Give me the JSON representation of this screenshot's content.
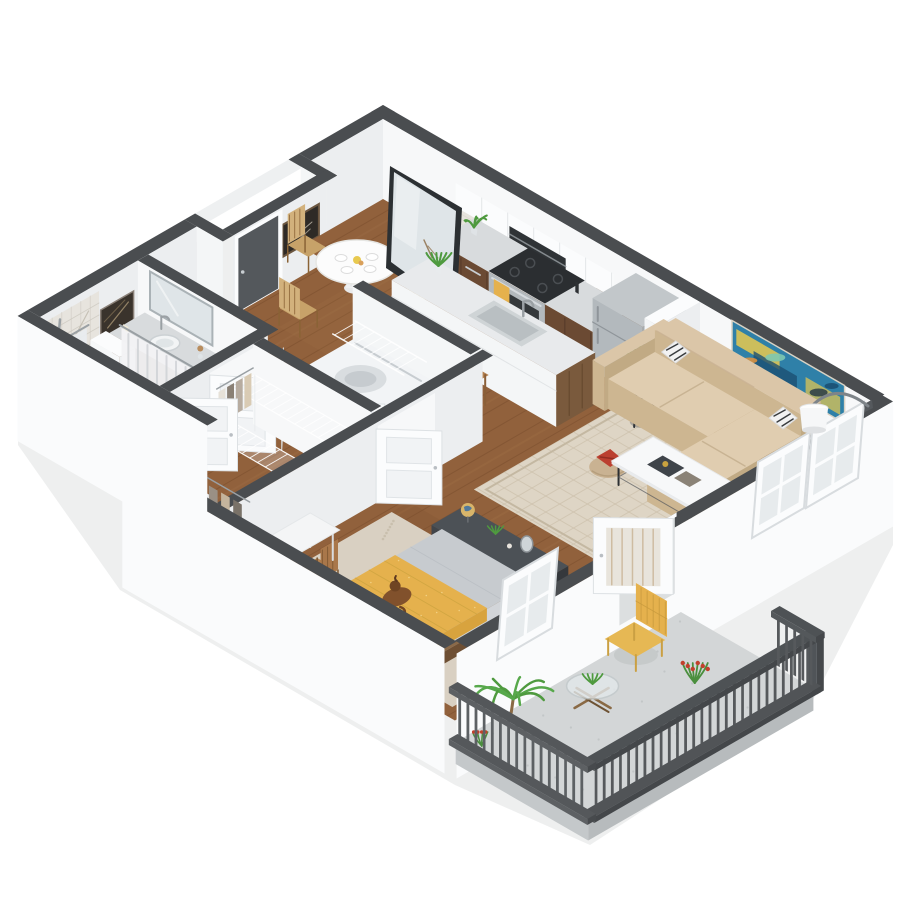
{
  "meta": {
    "type": "3d-floor-plan-render",
    "subject": "one-bedroom apartment isometric 3D floor plan with balcony",
    "background": "#ffffff"
  },
  "palette": {
    "cap": "#4a4d50",
    "wallBright": "#f7f8f9",
    "wallFace": "#f4f6f7",
    "wallShade": "#eceef0",
    "band": "#fafbfc",
    "floorWood": "#91613c",
    "floorLine": "#74492a",
    "floorLight": "#a5764b",
    "rugLiving": "#ded5c5",
    "rugLine": "#cdc1ac",
    "rugBed": "#d9d0c2",
    "concrete": "#d3d6d7",
    "concreteEdge": "#b7bbbd",
    "railing": "#56595c",
    "railingDark": "#4b4e51",
    "sofa": "#dbc6a8",
    "sofaShade": "#cdb691",
    "sofaDark": "#c1aa84",
    "counter": "#d8dbdd",
    "cabinetWood": "#6b4a33",
    "woodFurn": "#a9774a",
    "woodDark": "#7d5633",
    "steel": "#b3b9bd",
    "steelDark": "#9aa0a4",
    "white": "#fbfcfd",
    "dresser": "#41454a",
    "dresserTop": "#4c5156",
    "yellow": "#e5b14d",
    "yellowDark": "#caa23e",
    "teal": "#8fd7d2",
    "green": "#4f9a3f",
    "greenDark": "#3c7d30",
    "red": "#bb4030",
    "artTeal": "#2f80a8",
    "artYellow": "#e8c94f",
    "artDark": "#1c4f72",
    "mirror": "#dfe5e8",
    "glass": "#e3e8ea",
    "doorDark": "#54585c",
    "black": "#23262a",
    "chalk": "#2e2a26",
    "marbleArt": "#3a332c",
    "tile": "#e7e4de",
    "tileLine": "#cac6bd",
    "curtain": "#f2f3f5",
    "curtainLine": "#c9cdd1",
    "duvet": "#c7cbcf",
    "bedFrame": "#8a6a4a"
  },
  "rooms": [
    {
      "name": "kitchen",
      "items": [
        "upper-cabinets",
        "microwave",
        "tile-backsplash",
        "base-cabinets",
        "range-oven",
        "cooktop",
        "oven-towel",
        "refrigerator",
        "over-fridge-cabinet",
        "kitchen-island",
        "island-sink",
        "island-faucet",
        "bar-stools",
        "counter-plant",
        "island-plant"
      ]
    },
    {
      "name": "dining-area",
      "items": [
        "round-pedestal-table",
        "place-settings",
        "dining-chairs",
        "leaning-floor-mirror",
        "chalkboard-art"
      ]
    },
    {
      "name": "living-room",
      "items": [
        "sectional-sofa",
        "accent-pillows",
        "coffee-table",
        "books",
        "side-table",
        "pouf",
        "red-throw",
        "area-rug",
        "abstract-wall-art",
        "arc-wall-lamp",
        "plant-stand",
        "leaning-window-frames",
        "balcony-door"
      ]
    },
    {
      "name": "bedroom",
      "items": [
        "platform-bed",
        "yellow-throw-blanket",
        "white-pillows",
        "sleeping-dog",
        "area-rug",
        "dresser",
        "globe",
        "dresser-mirror",
        "dresser-plant",
        "desk",
        "desk-chair",
        "leaning-window-frame",
        "closet-clothes"
      ]
    },
    {
      "name": "bathroom",
      "items": [
        "bathtub",
        "shower-tile",
        "shower-head",
        "shower-curtain",
        "toilet",
        "vanity-cabinet",
        "vanity-sink",
        "vanity-mirror",
        "marble-wall-art",
        "towel-bar"
      ]
    },
    {
      "name": "hallway",
      "items": [
        "entry-door",
        "washer",
        "wire-shelving",
        "interior-doors"
      ]
    },
    {
      "name": "balcony",
      "items": [
        "patio-chair",
        "glass-patio-table",
        "palm-plant",
        "flower-plants",
        "railing",
        "concrete-floor"
      ]
    }
  ]
}
